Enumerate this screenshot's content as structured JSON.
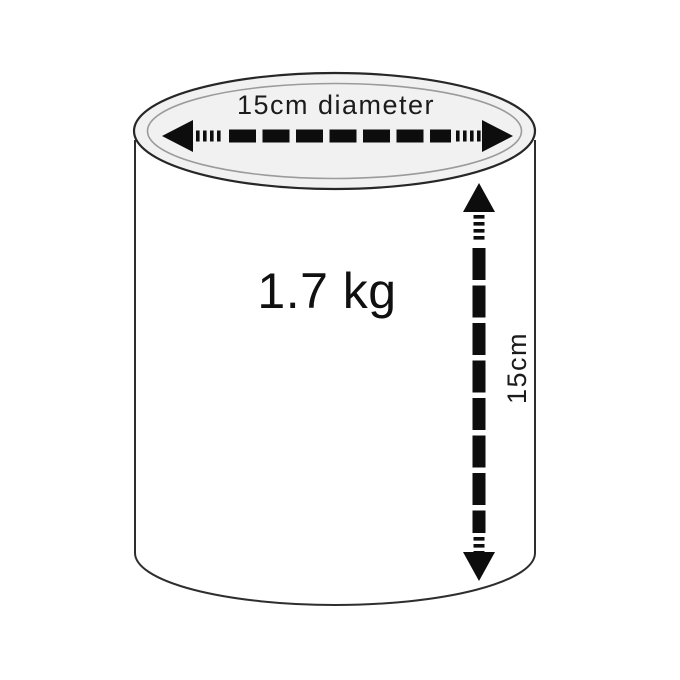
{
  "diagram": {
    "type": "cylinder-dimension-diagram",
    "labels": {
      "diameter": "15cm diameter",
      "weight": "1.7 kg",
      "height": "15cm"
    },
    "dimensions": {
      "diameter_cm": 15,
      "height_cm": 15,
      "weight_kg": 1.7
    },
    "colors": {
      "background": "#ffffff",
      "outline": "#2e2e2e",
      "top_fill": "#f1f1f1",
      "inner_rim": "#9b9b9b",
      "arrow": "#0d0d0d",
      "text": "#1b1b1b"
    }
  }
}
